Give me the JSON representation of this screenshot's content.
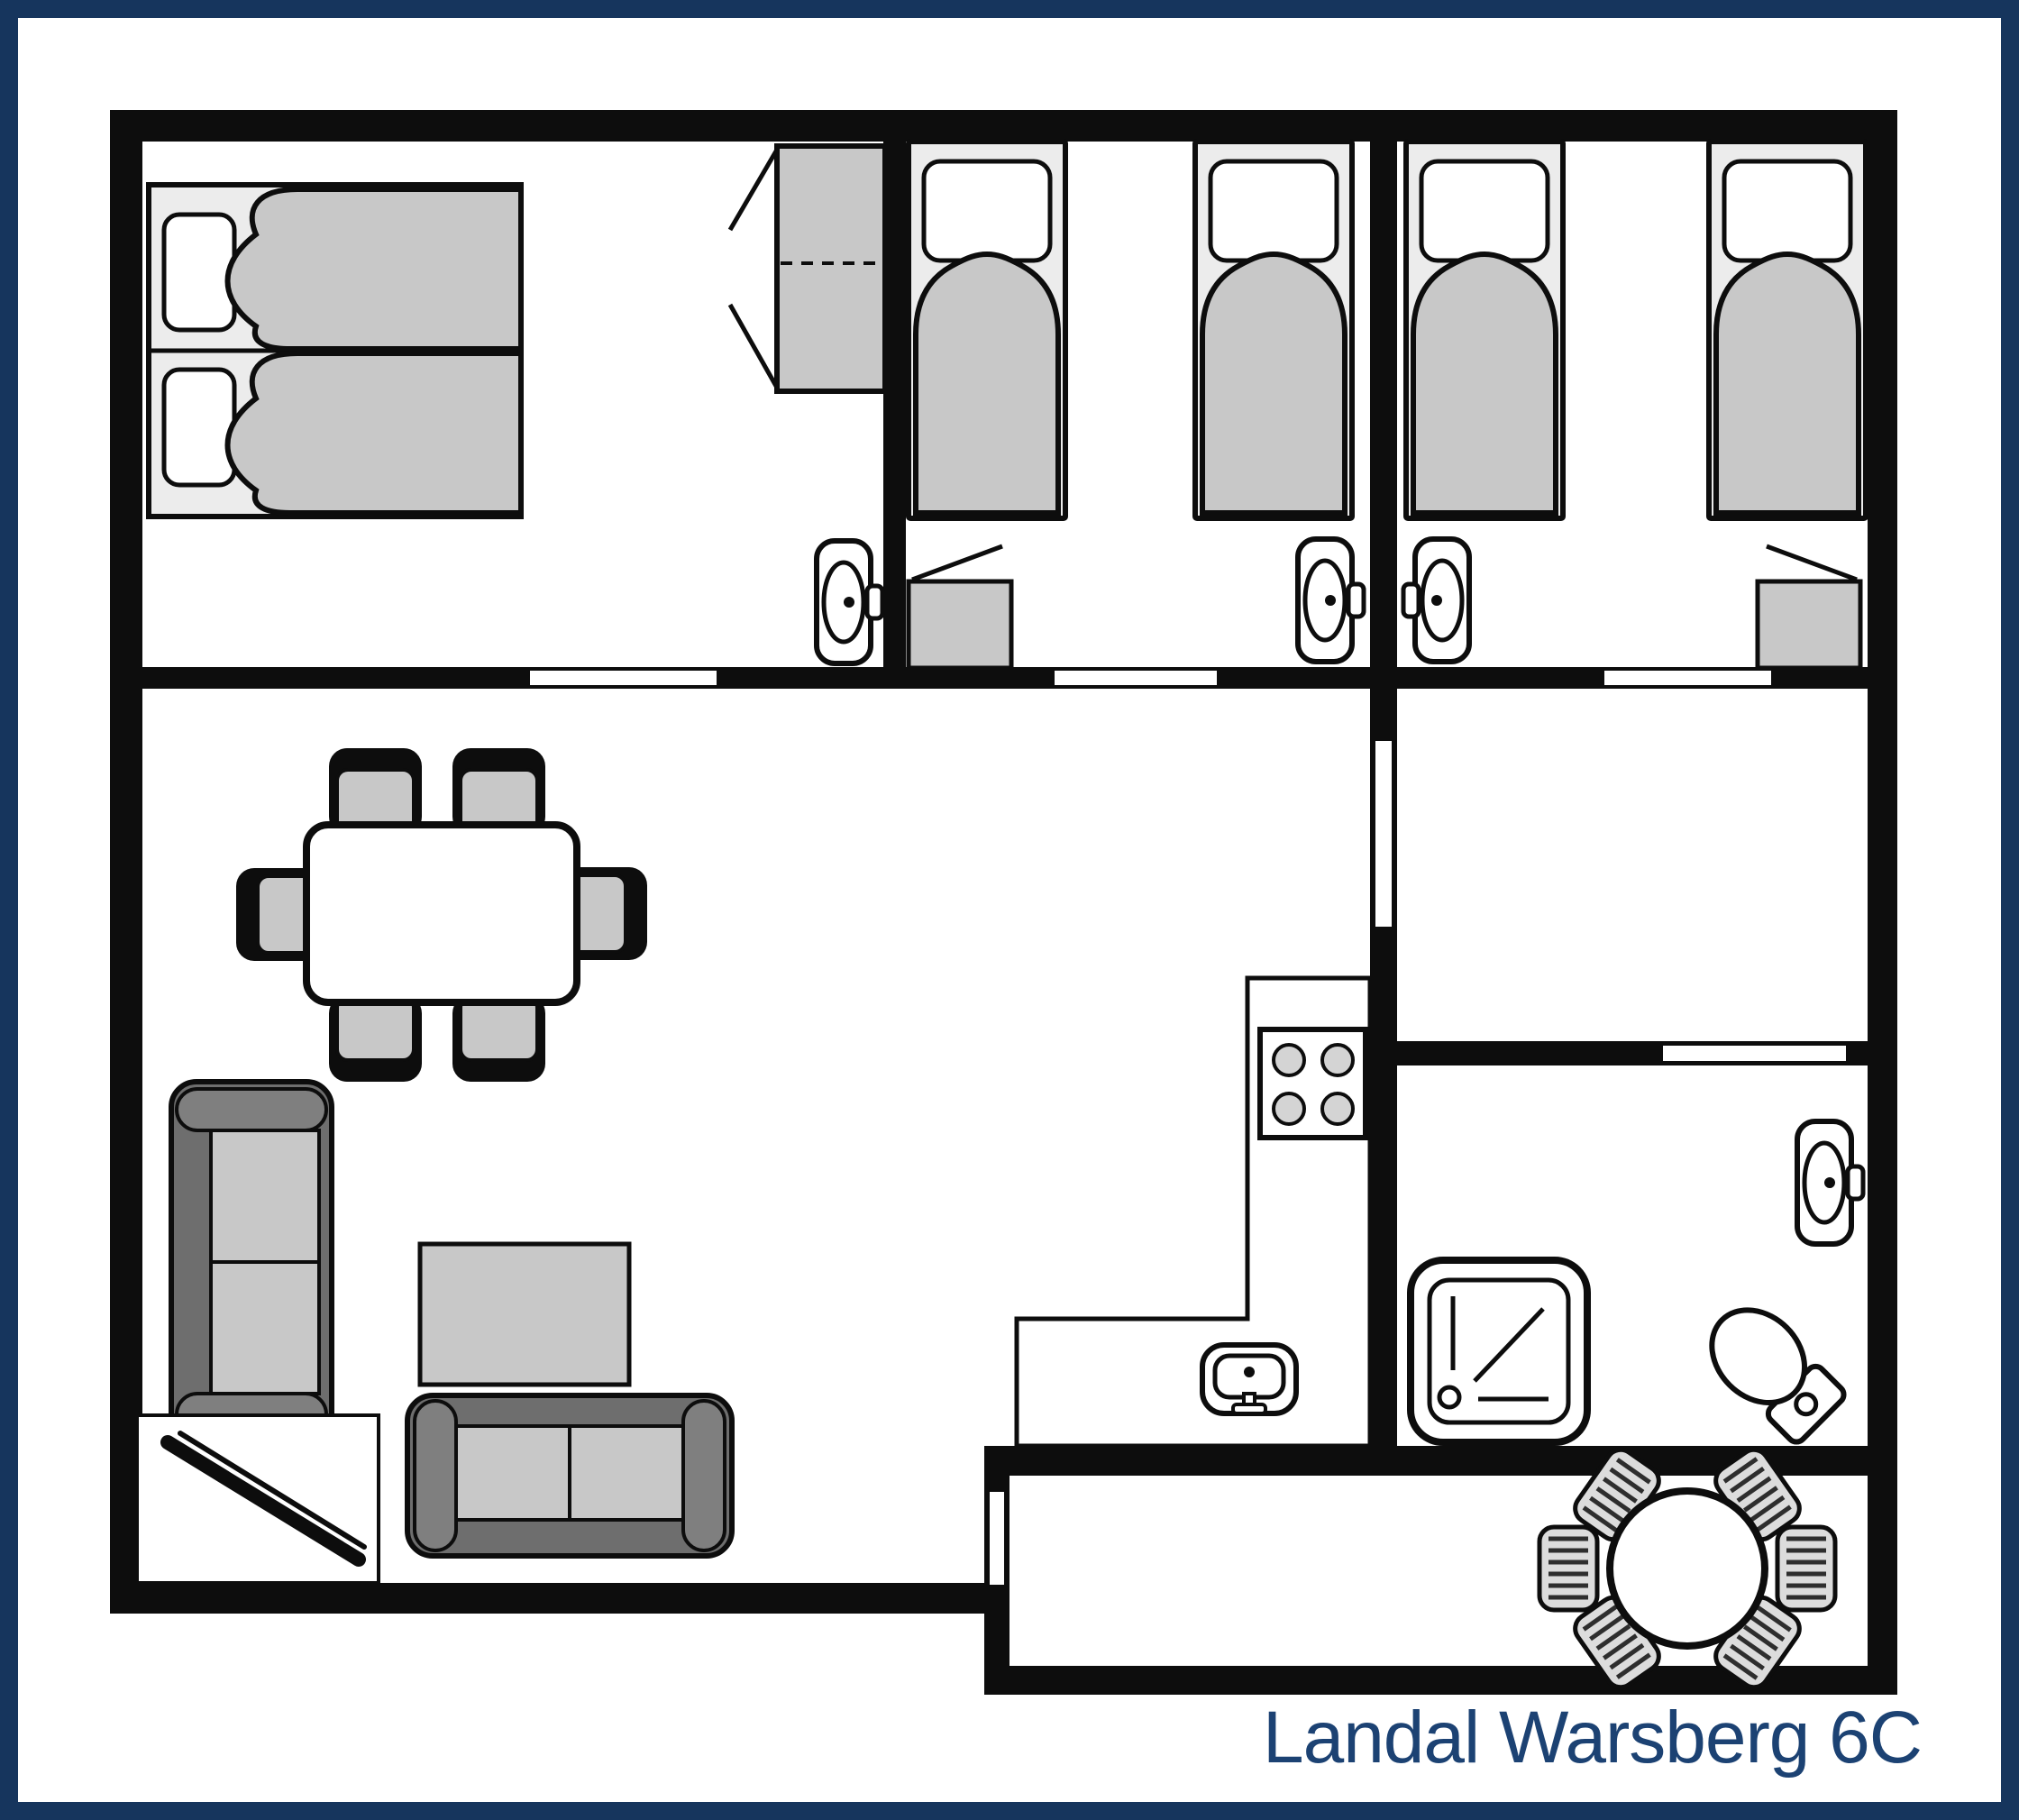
{
  "title": {
    "label": "Landal Warsberg 6C"
  },
  "colors": {
    "frame_navy": "#16355D",
    "title_navy": "#1C4273",
    "wall_black": "#0D0D0D",
    "furniture_gray": "#C8C8C8",
    "bedframe_gray": "#ECECEC",
    "sofa_dark_gray": "#6E6E6E",
    "sofa_arm_gray": "#7F7F7F",
    "terrace_chair_gray": "#DCDCDC",
    "burner_gray": "#D4D4D4",
    "stripe_gray": "#2E2E2E",
    "background_white": "#FFFFFF"
  }
}
